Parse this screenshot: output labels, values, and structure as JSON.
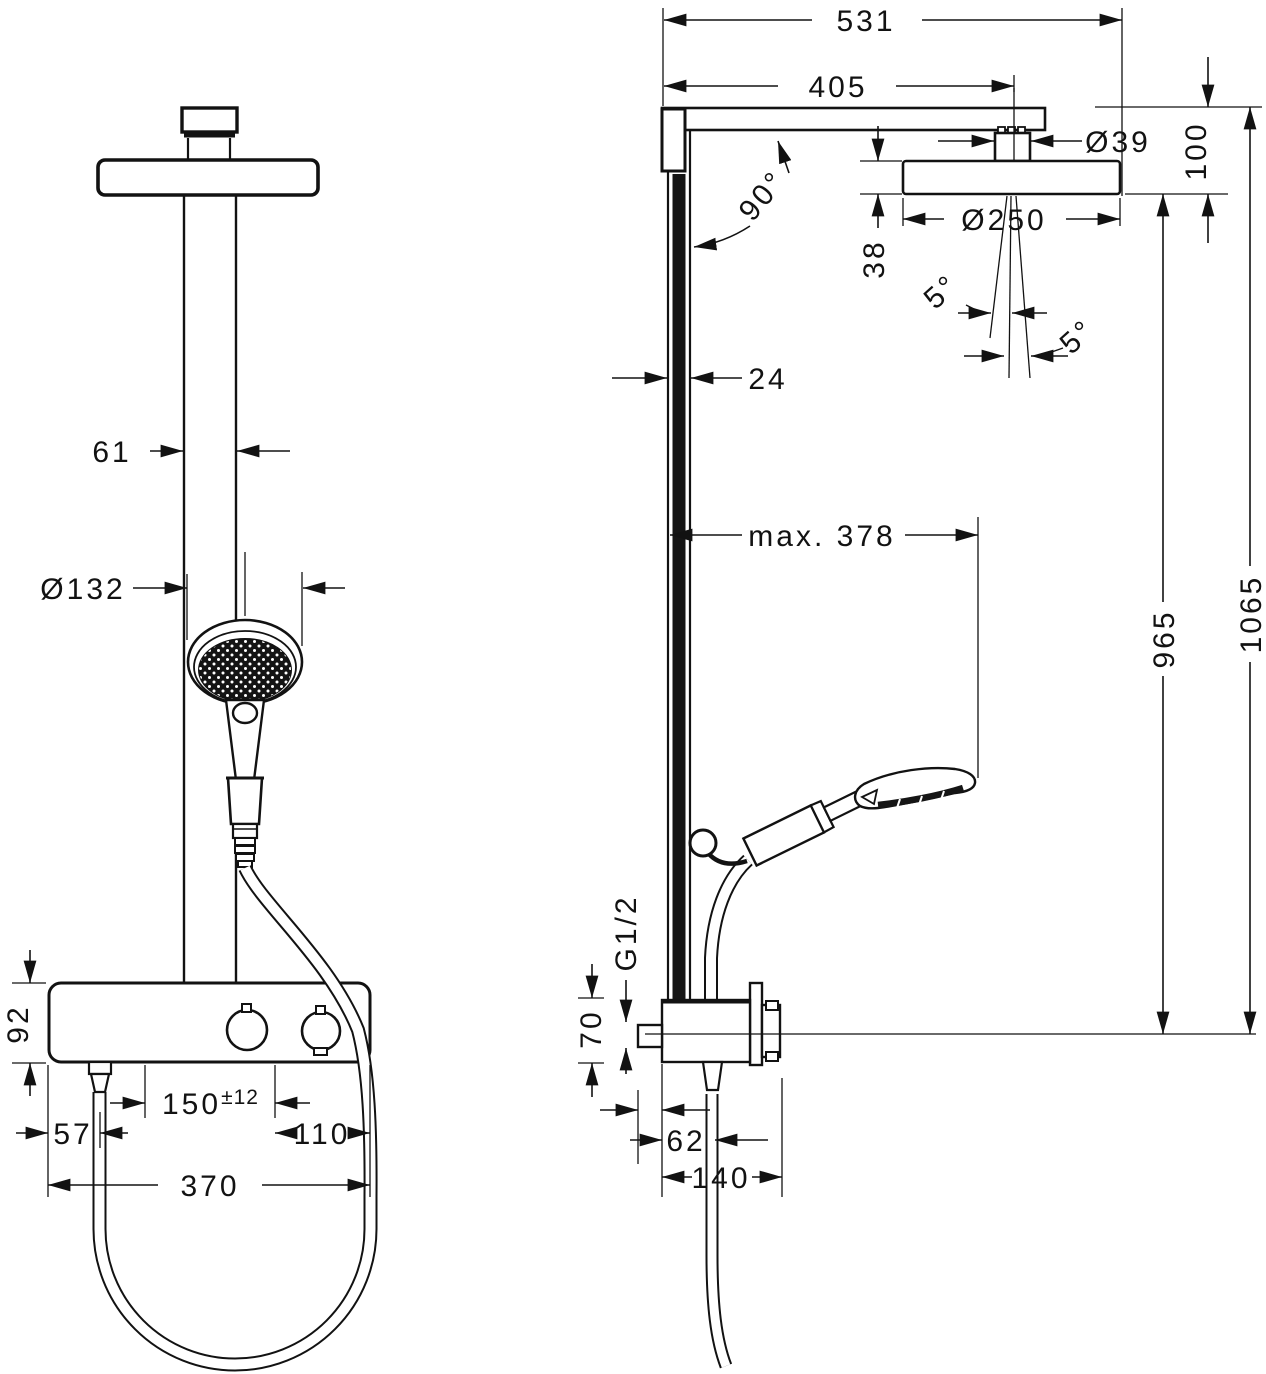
{
  "drawing_title": "Showerpipe technical dimension drawing (front and side view)",
  "front": {
    "pipe_width": "61",
    "handshower_diameter": "Ø132",
    "body_height": "92",
    "supply_distance": "150",
    "supply_tolerance": "±12",
    "edge_to_hose": "57",
    "supply_to_edge": "110",
    "body_width": "370"
  },
  "side": {
    "total_projection": "531",
    "projection_to_head_center": "405",
    "connector_diameter": "Ø39",
    "head_drop": "100",
    "arm_angle": "90°",
    "head_diameter": "Ø250",
    "head_thickness": "38",
    "spray_angle_left": "5°",
    "spray_angle_right": "5°",
    "bar_depth": "24",
    "hose_reach": "max. 378",
    "height_head_to_axis": "965",
    "height_arm_to_axis": "1065",
    "hose_thread": "G1/2",
    "body_height": "70",
    "hose_offset": "62",
    "wall_distance": "140"
  },
  "colors": {
    "line": "#121212",
    "background": "#ffffff"
  }
}
